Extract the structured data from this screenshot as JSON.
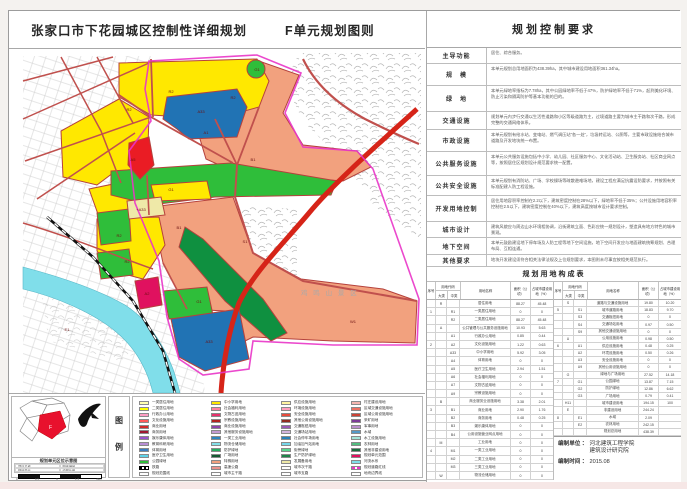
{
  "page": {
    "title": "张家口市下花园城区控制性详细规划",
    "subtitle": "F单元规划图则"
  },
  "map": {
    "scenic_label": "鸡 鸣 山 景 区",
    "zone_labels": [
      {
        "x": 170,
        "y": 92,
        "t": "R2"
      },
      {
        "x": 128,
        "y": 110,
        "t": "R2"
      },
      {
        "x": 232,
        "y": 98,
        "t": "R2"
      },
      {
        "x": 200,
        "y": 112,
        "t": "A33"
      },
      {
        "x": 256,
        "y": 70,
        "t": "G1"
      },
      {
        "x": 205,
        "y": 133,
        "t": "A1"
      },
      {
        "x": 252,
        "y": 160,
        "t": "B1"
      },
      {
        "x": 170,
        "y": 190,
        "t": "G1"
      },
      {
        "x": 132,
        "y": 160,
        "t": "A5"
      },
      {
        "x": 118,
        "y": 236,
        "t": "R2"
      },
      {
        "x": 126,
        "y": 262,
        "t": "R2"
      },
      {
        "x": 146,
        "y": 294,
        "t": "A2"
      },
      {
        "x": 178,
        "y": 228,
        "t": "B1"
      },
      {
        "x": 198,
        "y": 302,
        "t": "G1"
      },
      {
        "x": 208,
        "y": 342,
        "t": "A33"
      },
      {
        "x": 352,
        "y": 322,
        "t": "W1"
      },
      {
        "x": 66,
        "y": 330,
        "t": "E1"
      },
      {
        "x": 244,
        "y": 242,
        "t": "S1"
      },
      {
        "x": 140,
        "y": 210,
        "t": "+A33"
      }
    ],
    "colors": {
      "residential_yellow": "#FFE800",
      "commercial_red": "#EA1C24",
      "special_salmon": "#F2A17E",
      "park_green": "#2FBE3A",
      "protective_green": "#0F9040",
      "education_blue": "#2173B4",
      "water_cyan": "#80DEEA",
      "medical_crimson": "#E0115F",
      "reserve_cream": "#EFE9A8",
      "expressway_red": "#D62418",
      "road_red": "#C0504D",
      "boundary_magenta": "#E935C8"
    }
  },
  "control_panel": {
    "header": "规划控制要求",
    "rows": [
      {
        "label": "主导功能",
        "text": "居住、综合服务。"
      },
      {
        "label": "规　模",
        "text": "本单元规划总用地面积为438.39ha，其中城市建设用地面积361.34ha。"
      },
      {
        "label": "绿　地",
        "text": "本单元绿地率指标为7.78ha，其中公园绿地率不低于47%，防护绿地率不低于71%，起到美化环境、防止污染和隔离防护等基本功能的目的。"
      },
      {
        "label": "交通设施",
        "text": "规划单元内步行交通以生活性道路和小区等级道路为主，过境道路主要为城市主干路和次干路，形成完整的交通网络体系。"
      },
      {
        "label": "市政设施",
        "text": "本单元规划有给水站、变电站、燃气调压站“各一处”，垃圾转运站、公厕等，主要市政设施结合城市道路及开发地块统一布置。"
      },
      {
        "label": "公共服务设施",
        "text": "本单元公共服务设施包括中小学、幼儿园、社区服务中心、文化活动站、卫生服务站、社区商业网点等，按照居住区规划设计规范要求统一配置。"
      },
      {
        "label": "公共安全设施",
        "text": "本单元规划有消防站、广场、学校操场等疏散避难场地，建设工程应满足抗震设防要求，并按照有关标准配建人防工程设施。"
      },
      {
        "label": "开发用地控制",
        "text": "居住用地容积率控制在2.2以下，建筑密度控制在28%以下，绿地率不低于35%；公共设施用地容积率控制在2.5以下，建筑密度控制在40%以下，建筑高度按城市设计要求控制。"
      },
      {
        "label": "城市设计",
        "text": "建筑风貌应与周边山水环境相协调，沿街建筑立面、色彩应统一规划设计，塑造具有地方特色的城市景观。"
      },
      {
        "label": "地下空间",
        "text": "本单元鼓励建设地下停车场及人防工程等地下空间设施，地下空间开发应与地面建筑统筹规划、合理布局、互相连通。"
      },
      {
        "label": "其他要求",
        "text": "地块开发建设须符合相关法律法规及上位规划要求，本图则未尽事宜按相关规范执行。"
      }
    ]
  },
  "composition_table": {
    "title": "规划用地构成表",
    "col_headers": {
      "seq": "序号",
      "code": "用地代码",
      "major": "大类",
      "middle": "中类",
      "name": "用地名称",
      "area": "面积（公顷）",
      "pct": "占城市建设用地（%）"
    },
    "left_rows": [
      {
        "seq": "",
        "mj": "R",
        "md": "",
        "name": "居住用地",
        "area": "88.27",
        "pct": "45.48"
      },
      {
        "seq": "1",
        "mj": "",
        "md": "R1",
        "name": "一类居住用地",
        "area": "0",
        "pct": "0"
      },
      {
        "seq": "",
        "mj": "",
        "md": "R2",
        "name": "二类居住用地",
        "area": "88.27",
        "pct": "45.48"
      },
      {
        "seq": "",
        "mj": "A",
        "md": "",
        "name": "公共管理与公共服务设施用地",
        "area": "10.93",
        "pct": "5.63"
      },
      {
        "seq": "",
        "mj": "",
        "md": "A1",
        "name": "行政办公用地",
        "area": "0.85",
        "pct": "0.44"
      },
      {
        "seq": "2",
        "mj": "",
        "md": "A2",
        "name": "文化设施用地",
        "area": "1.22",
        "pct": "0.63"
      },
      {
        "seq": "",
        "mj": "",
        "md": "A33",
        "name": "中小学用地",
        "area": "5.92",
        "pct": "3.05"
      },
      {
        "seq": "",
        "mj": "",
        "md": "A4",
        "name": "体育用地",
        "area": "0",
        "pct": "0"
      },
      {
        "seq": "",
        "mj": "",
        "md": "A5",
        "name": "医疗卫生用地",
        "area": "2.94",
        "pct": "1.51"
      },
      {
        "seq": "",
        "mj": "",
        "md": "A6",
        "name": "社会福利用地",
        "area": "0",
        "pct": "0"
      },
      {
        "seq": "",
        "mj": "",
        "md": "A7",
        "name": "文物古迹用地",
        "area": "0",
        "pct": "0"
      },
      {
        "seq": "",
        "mj": "",
        "md": "A9",
        "name": "宗教设施用地",
        "area": "0",
        "pct": "0"
      },
      {
        "seq": "",
        "mj": "B",
        "md": "",
        "name": "商业服务业设施用地",
        "area": "3.38",
        "pct": "2.01"
      },
      {
        "seq": "3",
        "mj": "",
        "md": "B1",
        "name": "商业用地",
        "area": "2.90",
        "pct": "1.76"
      },
      {
        "seq": "",
        "mj": "",
        "md": "B2",
        "name": "商务用地",
        "area": "0.48",
        "pct": "0.25"
      },
      {
        "seq": "",
        "mj": "",
        "md": "B3",
        "name": "娱乐康体用地",
        "area": "0",
        "pct": "0"
      },
      {
        "seq": "",
        "mj": "",
        "md": "B4",
        "name": "公用设施营业网点用地",
        "area": "0",
        "pct": "0"
      },
      {
        "seq": "",
        "mj": "M",
        "md": "",
        "name": "工业用地",
        "area": "0",
        "pct": "0"
      },
      {
        "seq": "4",
        "mj": "",
        "md": "M1",
        "name": "一类工业用地",
        "area": "0",
        "pct": "0"
      },
      {
        "seq": "",
        "mj": "",
        "md": "M2",
        "name": "二类工业用地",
        "area": "0",
        "pct": "0"
      },
      {
        "seq": "",
        "mj": "",
        "md": "M3",
        "name": "三类工业用地",
        "area": "0",
        "pct": "0"
      },
      {
        "seq": "",
        "mj": "W",
        "md": "",
        "name": "物流仓储用地",
        "area": "0",
        "pct": "0"
      }
    ],
    "right_rows": [
      {
        "seq": "",
        "mj": "S",
        "md": "",
        "name": "道路与交通设施用地",
        "area": "19.80",
        "pct": "10.20"
      },
      {
        "seq": "5",
        "mj": "",
        "md": "S1",
        "name": "城市道路用地",
        "area": "18.83",
        "pct": "9.70"
      },
      {
        "seq": "",
        "mj": "",
        "md": "S3",
        "name": "交通枢纽用地",
        "area": "0",
        "pct": "0"
      },
      {
        "seq": "",
        "mj": "",
        "md": "S4",
        "name": "交通场站用地",
        "area": "0.97",
        "pct": "0.50"
      },
      {
        "seq": "",
        "mj": "",
        "md": "S9",
        "name": "其他交通设施用地",
        "area": "0",
        "pct": "0"
      },
      {
        "seq": "",
        "mj": "U",
        "md": "",
        "name": "公用设施用地",
        "area": "0.98",
        "pct": "0.50"
      },
      {
        "seq": "6",
        "mj": "",
        "md": "U1",
        "name": "供应设施用地",
        "area": "0.48",
        "pct": "0.25"
      },
      {
        "seq": "",
        "mj": "",
        "md": "U2",
        "name": "环境设施用地",
        "area": "0.50",
        "pct": "0.26"
      },
      {
        "seq": "",
        "mj": "",
        "md": "U3",
        "name": "安全设施用地",
        "area": "0",
        "pct": "0"
      },
      {
        "seq": "",
        "mj": "",
        "md": "U9",
        "name": "其他公用设施用地",
        "area": "0",
        "pct": "0"
      },
      {
        "seq": "",
        "mj": "G",
        "md": "",
        "name": "绿地与广场用地",
        "area": "27.52",
        "pct": "14.18"
      },
      {
        "seq": "7",
        "mj": "",
        "md": "G1",
        "name": "公园绿地",
        "area": "13.87",
        "pct": "7.15"
      },
      {
        "seq": "",
        "mj": "",
        "md": "G2",
        "name": "防护绿地",
        "area": "12.86",
        "pct": "6.62"
      },
      {
        "seq": "",
        "mj": "",
        "md": "G3",
        "name": "广场用地",
        "area": "0.79",
        "pct": "0.41"
      },
      {
        "seq": "",
        "mj": "H11",
        "md": "",
        "name": "城市建设用地",
        "area": "194.15",
        "pct": "100"
      },
      {
        "seq": "",
        "mj": "E",
        "md": "",
        "name": "非建设用地",
        "area": "244.24",
        "pct": ""
      },
      {
        "seq": "8",
        "mj": "",
        "md": "E1",
        "name": "水域",
        "area": "2.09",
        "pct": ""
      },
      {
        "seq": "",
        "mj": "",
        "md": "E2",
        "name": "农林用地",
        "area": "242.15",
        "pct": ""
      },
      {
        "seq": "",
        "mj": "",
        "md": "",
        "name": "规划总用地",
        "area": "438.39",
        "pct": ""
      }
    ],
    "footer": {
      "org_label": "编制单位 ：",
      "org_line1": "河北建筑工程学院",
      "org_line2": "建筑设计研究院",
      "date_label": "编制时间 ：",
      "date_value": "2015.08"
    }
  },
  "keymap": {
    "caption": "规划单元区位示意图",
    "unit_letter": "F",
    "info_cells": [
      "项目名称",
      "图纸编号",
      "规划单元",
      "绘图比例"
    ],
    "scale_ticks": [
      "0",
      "0.5",
      "1",
      "1.5",
      "2km"
    ]
  },
  "legend": {
    "label": "图 例",
    "columns": [
      [
        {
          "c": "#FFFFB0",
          "t": "一类居住用地"
        },
        {
          "c": "#FFFF00",
          "t": "二类居住用地"
        },
        {
          "c": "#FF9EC4",
          "t": "行政办公用地"
        },
        {
          "c": "#FF5A5A",
          "t": "文化设施用地"
        },
        {
          "c": "#D42A2A",
          "t": "商业用地"
        },
        {
          "c": "#A01830",
          "t": "商务用地"
        },
        {
          "c": "#9955CC",
          "t": "娱乐康体用地"
        },
        {
          "c": "#B98FD6",
          "t": "教育科研用地"
        },
        {
          "c": "#3E7FC1",
          "t": "体育用地"
        },
        {
          "c": "#5FD3E8",
          "t": "医疗卫生用地"
        },
        {
          "c": "#2FBE3A",
          "t": "公园绿地"
        },
        {
          "sym": "rail",
          "t": "铁路"
        },
        {
          "sym": "box",
          "t": "规划范围线"
        }
      ],
      [
        {
          "c": "#FFE800",
          "t": "中小学用地"
        },
        {
          "c": "#FF80A0",
          "t": "社会福利用地"
        },
        {
          "c": "#E8336E",
          "t": "文物古迹用地"
        },
        {
          "c": "#B22222",
          "t": "宗教设施用地"
        },
        {
          "c": "#8E44AD",
          "t": "商业设施用地"
        },
        {
          "c": "#C39BD3",
          "t": "其他服务设施用地"
        },
        {
          "c": "#2E86C1",
          "t": "一类工业用地"
        },
        {
          "c": "#85E0E8",
          "t": "物流仓储用地"
        },
        {
          "c": "#27AE60",
          "t": "防护绿地"
        },
        {
          "c": "#145A32",
          "t": "广场用地"
        },
        {
          "c": "#F2A17E",
          "t": "特殊用地"
        },
        {
          "sym": "expy",
          "t": "高速公路"
        },
        {
          "sym": "road",
          "t": "城市主干路"
        }
      ],
      [
        {
          "c": "#FFF3A0",
          "t": "供应设施用地"
        },
        {
          "c": "#FF9EBB",
          "t": "环境设施用地"
        },
        {
          "c": "#E74C3C",
          "t": "安全设施用地"
        },
        {
          "c": "#922B21",
          "t": "其他公用设施用地"
        },
        {
          "c": "#9B59B6",
          "t": "交通枢纽用地"
        },
        {
          "c": "#D2B4DE",
          "t": "交通场站用地"
        },
        {
          "c": "#2980B9",
          "t": "社会停车场用地"
        },
        {
          "c": "#76D7EA",
          "t": "加油加气站用地"
        },
        {
          "c": "#58D68D",
          "t": "街旁绿地"
        },
        {
          "c": "#1E8449",
          "t": "生产防护绿地"
        },
        {
          "c": "#EFE9A8",
          "t": "发展备用地"
        },
        {
          "sym": "road2",
          "t": "城市次干路"
        },
        {
          "sym": "road3",
          "t": "城市支路"
        }
      ],
      [
        {
          "c": "#F5B7B1",
          "t": "村庄建设用地"
        },
        {
          "c": "#EC7063",
          "t": "区域交通设施用地"
        },
        {
          "c": "#CB4335",
          "t": "区域公用设施用地"
        },
        {
          "c": "#7D3C98",
          "t": "采矿用地"
        },
        {
          "c": "#BB8FCE",
          "t": "军事用地"
        },
        {
          "c": "#5499C7",
          "t": "水域"
        },
        {
          "c": "#A3E4D7",
          "t": "水工设施用地"
        },
        {
          "c": "#52BE80",
          "t": "农林用地"
        },
        {
          "c": "#196F3D",
          "t": "其他非建设用地"
        },
        {
          "c": "#E0115F",
          "t": "规划单元范围"
        },
        {
          "c": "#80DEEA",
          "t": "河流水系"
        },
        {
          "sym": "dash",
          "t": "规划道路红线"
        },
        {
          "sym": "box",
          "t": "地块边界线"
        }
      ]
    ]
  }
}
